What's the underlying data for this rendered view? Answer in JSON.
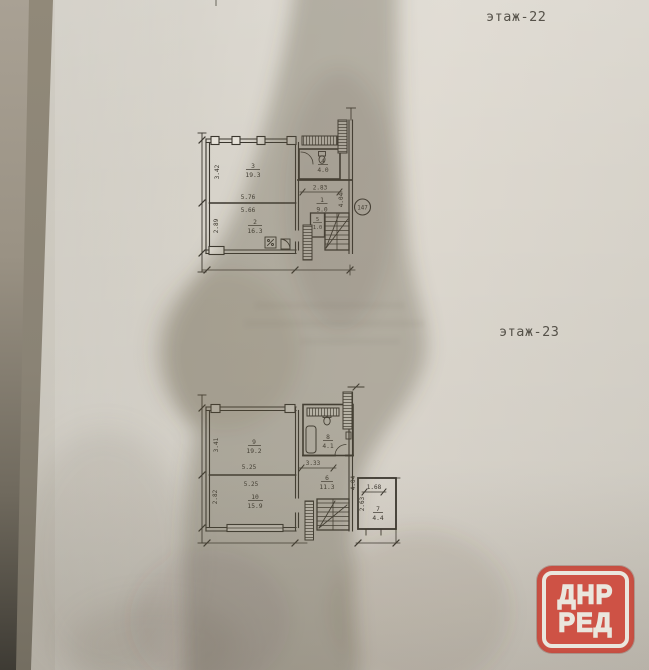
{
  "titles": {
    "floor22": "этаж-22",
    "floor23": "этаж-23"
  },
  "plan_floor22": {
    "apartment_badge": "147",
    "rooms": [
      {
        "number": "3",
        "area": "19.3"
      },
      {
        "number": "2",
        "area": "16.3"
      },
      {
        "number": "4",
        "area": "4.0"
      },
      {
        "number": "1",
        "area": "9.0"
      },
      {
        "number": "5",
        "area": "1.0"
      }
    ],
    "dimensions": {
      "room3_height": "3.42",
      "room2_height": "2.89",
      "rooms_width_top": "5.76",
      "rooms_width_bottom": "5.66",
      "hall_width": "2.83",
      "right_height": "4.04"
    }
  },
  "plan_floor23": {
    "rooms": [
      {
        "number": "9",
        "area": "19.2"
      },
      {
        "number": "10",
        "area": "15.9"
      },
      {
        "number": "8",
        "area": "4.1"
      },
      {
        "number": "6",
        "area": "11.3"
      },
      {
        "number": "7",
        "area": "4.4"
      }
    ],
    "dimensions": {
      "room9_height": "3.41",
      "room10_height": "2.82",
      "rooms_width_top": "5.25",
      "rooms_width_bottom": "5.25",
      "corridor_width": "3.33",
      "right_height": "4.04",
      "annex_width": "1.68",
      "annex_height": "2.63"
    }
  },
  "watermark": {
    "line1": "ДНР",
    "line2": "РЕД",
    "color": "#cf4f42"
  },
  "colors": {
    "paper": "#d7d3ca",
    "ink": "#3a362e"
  }
}
